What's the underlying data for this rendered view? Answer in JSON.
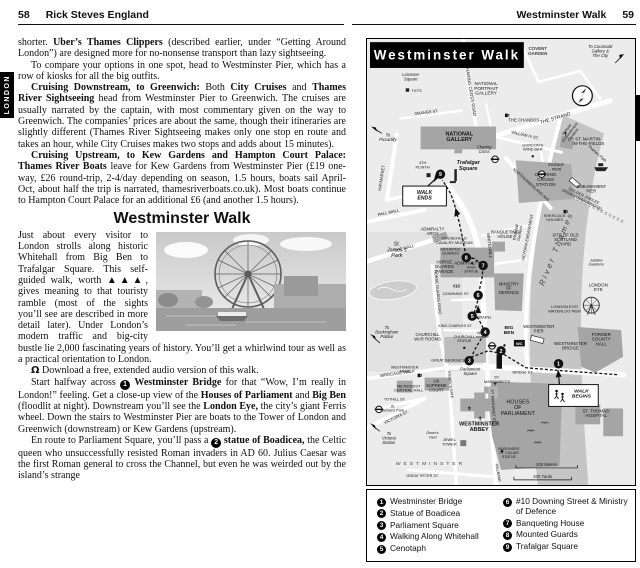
{
  "left": {
    "page_num": "58",
    "book_title": "Rick Steves England",
    "tab": "LONDON",
    "heading": "Westminster Walk",
    "p1": [
      {
        "t": "shorter. "
      },
      {
        "t": "Uber’s Thames Clippers",
        "b": 1
      },
      {
        "t": " (described earlier, under “Getting Around London”) are designed more for no-nonsense transport than lazy sightseeing."
      }
    ],
    "p2": [
      {
        "t": "To compare your options in one spot, head to Westminster Pier, which has a row of kiosks for all the big outfits."
      }
    ],
    "p3": [
      {
        "t": "Cruising Downstream, to Greenwich:",
        "b": 1
      },
      {
        "t": " Both "
      },
      {
        "t": "City Cruises",
        "b": 1
      },
      {
        "t": " and "
      },
      {
        "t": "Thames River Sightseeing",
        "b": 1
      },
      {
        "t": " head from Westminster Pier to Greenwich. The cruises are usually narrated by the captain, with most commentary given on the way to Greenwich. The companies’ prices are about the same, though their itineraries are slightly different (Thames River Sightseeing makes only one stop en route and takes an hour, while City Cruises makes two stops and adds about 15 minutes)."
      }
    ],
    "p4": [
      {
        "t": "Cruising Upstream, to Kew Gardens and Hampton Court Palace: Thames River Boats",
        "b": 1
      },
      {
        "t": " leave for Kew Gardens from Westminster Pier (£19 one-way, £26 round-trip, 2-4/day depending on season, 1.5 hours, boats sail April-Oct, about half the trip is narrated, thamesriverboats.co.uk). Most boats continue to Hampton Court Palace for an additional £6 (and another 1.5 hours)."
      }
    ],
    "p5": [
      {
        "t": "Just about every visitor to London strolls along historic Whitehall from Big Ben to Trafalgar Square. This self-guided walk, worth ▲▲▲, gives meaning to that touristy ramble (most of the sights you’ll see are described in more detail later). Under London’s modern traffic and big-city bustle lie 2,000 fascinating years of history. You’ll get a whirlwind tour as well as a practical orientation to London."
      }
    ],
    "p6": [
      {
        "t": "Ω",
        "icon": 1
      },
      {
        "t": " Download a free, extended audio version of this walk."
      }
    ],
    "p7": [
      {
        "t": "Start halfway across "
      },
      {
        "t": "1",
        "stop": 1
      },
      {
        "t": " "
      },
      {
        "t": "Westminster Bridge",
        "b": 1
      },
      {
        "t": " for that “Wow, I’m really in London!” feeling. Get a close-up view of the "
      },
      {
        "t": "Houses of Parliament",
        "b": 1
      },
      {
        "t": " and "
      },
      {
        "t": "Big Ben",
        "b": 1
      },
      {
        "t": " (floodlit at night). Downstream you’ll see the "
      },
      {
        "t": "London Eye,",
        "b": 1
      },
      {
        "t": " the city’s giant Ferris wheel. Down the stairs to Westminster Pier are boats to the Tower of London and Greenwich (downstream) or Kew Gardens (upstream)."
      }
    ],
    "p8": [
      {
        "t": "En route to Parliament Square, you’ll pass a "
      },
      {
        "t": "2",
        "stop": 1
      },
      {
        "t": " "
      },
      {
        "t": "statue of Boadicea,",
        "b": 1
      },
      {
        "t": " the Celtic queen who unsuccessfully resisted Roman invaders in AD 60. Julius Caesar was the first Roman general to cross the Channel, but even he was weirded out by the island’s strange"
      }
    ]
  },
  "right": {
    "header_title": "Westminster Walk",
    "page_num": "59",
    "tab": "LONDON",
    "map": {
      "title": "Westminster Walk",
      "stops": [
        "1",
        "2",
        "3",
        "4",
        "5",
        "6",
        "7",
        "8",
        "9"
      ],
      "scale_meters": "200 Meters",
      "scale_yards": "200 Yards",
      "labels": {
        "covent": "COVENT\nGARDEN",
        "courtauld": "To Courtauld\nGallery &\nThe City",
        "leicester_tube": "Leicester\nSquare",
        "leicester_sq": "Leicester\nSquare",
        "tkts": "TKTS",
        "charing_cross_rd": "CHARING CROSS ROAD",
        "npg": "NATIONAL\nPORTRAIT\nGALLERY",
        "orange": "ORANGE ST.",
        "chandos": "THE CHANDOS",
        "william_iv": "WILLIAM IV ST.",
        "st_martin": "ST. MARTIN-\nIN-THE-FIELDS",
        "strand": "THE STRAND",
        "national_gallery": "NATIONAL\nGALLERY",
        "trafalgar": "Trafalgar\nSquare",
        "plinth": "4TH\nPLINTH",
        "walk_ends": "WALK\nENDS",
        "to_piccadilly": "To\nPiccadilly",
        "haymarket": "HAYMARKET",
        "pall_mall": "PALL MALL",
        "charing_cross": "Charing\nCross",
        "cx_station": "CHARING\nCROSS\nSTATION",
        "sherlock": "SHERLOCK\nHOLMES",
        "northumberland": "NORTHUMBERLAND AVE.",
        "vic_emb_gardens": "Victoria\nEmbankment\nGardens",
        "gordons": "GORDON’S\nWINE BAR",
        "embankment": "Embank-\nment",
        "embankment_pier": "EMBANKMENT\nPIER",
        "golden_jubilee": "GOLDEN JUBILEE\n(PEDESTRIAN BRIDGE)",
        "thames_path": "Thames Path",
        "river": "River Thames",
        "admiralty_arch": "ADMIRALTY\nARCH",
        "the_mall": "THE MALL",
        "old_admiralty": "OLD\nADMIRALTY",
        "scotland_yard": "SITE OF OLD\nSCOTLAND\nYARD",
        "whitehall": "WHITEHALL",
        "cavalry": "HOUSEHOLD\nCAVALRY MUSEUM",
        "mounted_guards": "MOUNTED\nGUARDS",
        "horse_guards_parade": "HORSE\nGUARDS\nPARADE",
        "haig": "HAIG\nSTATUE",
        "st_james_park": "St.\nJames’s\nPark",
        "horse_guards_rd": "HORSE GUARDS ROAD",
        "banqueting": "BANQUETING\nHOUSE",
        "mod": "MINISTRY\nOF\nDEFENCE",
        "number10": "#10",
        "downing": "DOWNING ST.",
        "cenotaph": "CENOTAPH",
        "king_charles": "KING CHARLES ST.",
        "victoria_embankment": "VICTORIA EMBANKMENT",
        "whitehall_gardens": "Whitehall\nGardens",
        "jubilee_gardens": "Jubilee\nGardens",
        "london_eye": "LONDON\nEYE",
        "waterloo_pier": "LONDON EYE/\nWATERLOO PIER",
        "westminster_pier": "WESTMINSTER\nPIER",
        "county_hall": "FORMER\nCOUNTY\nHALL",
        "to_buckingham": "To\nBuckingham\nPalace",
        "war_rooms": "CHURCHILL\nWAR ROOMS",
        "churchill": "CHURCHILL\nSTATUE",
        "birdcage": "BIRDCAGE WALK",
        "great_george": "GREAT GEORGE ST.",
        "parliament_sq": "Parliament\nSquare",
        "westminster_tube": "West-\nminster",
        "wc": "WC",
        "big_ben": "BIG\nBEN",
        "westminster_bridge": "WESTMINSTER\nBRIDGE",
        "bridge_st": "BRIDGE ST.",
        "walk_begins": "WALK\nBEGINS",
        "houses_parliament": "HOUSES\nOF\nPARLIAMENT",
        "st_thomas": "ST. THOMAS’\nHOSPITAL",
        "burghers": "BURGHERS\nOF CALAIS\nSTATUE",
        "abbey": "WESTMINSTER\nABBEY",
        "st_margarets": "ST.\nMARGARET’S",
        "supreme_court": "UK\nSUPREME\nCOURT",
        "wm_arms": "WESTMINSTER\nARMS",
        "methodist": "METHODIST\nCENTRAL HALL",
        "tothill": "TOTHILL ST.",
        "sjp_tube": "St.\nJames’s Park",
        "victoria_st": "VICTORIA ST.",
        "to_victoria": "To\nVictoria\nStation",
        "deans_yard": "Dean’s\nYard",
        "jewel": "JEWEL\nTOWER",
        "westminster_area": "WESTMINSTER",
        "great_peter": "GREAT PETER ST.",
        "st_margaret_st": "ST. MARGARET ST.",
        "millbank": "MILLBANK",
        "storeys": "STOREY’S GATE"
      },
      "legend": [
        {
          "n": "1",
          "label": "Westminster Bridge"
        },
        {
          "n": "2",
          "label": "Statue of Boadicea"
        },
        {
          "n": "3",
          "label": "Parliament Square"
        },
        {
          "n": "4",
          "label": "Walking Along Whitehall"
        },
        {
          "n": "5",
          "label": "Cenotaph"
        },
        {
          "n": "6",
          "label": "#10 Downing Street & Ministry of Defence"
        },
        {
          "n": "7",
          "label": "Banqueting House"
        },
        {
          "n": "8",
          "label": "Mounted Guards"
        },
        {
          "n": "9",
          "label": "Trafalgar Square"
        }
      ]
    }
  }
}
